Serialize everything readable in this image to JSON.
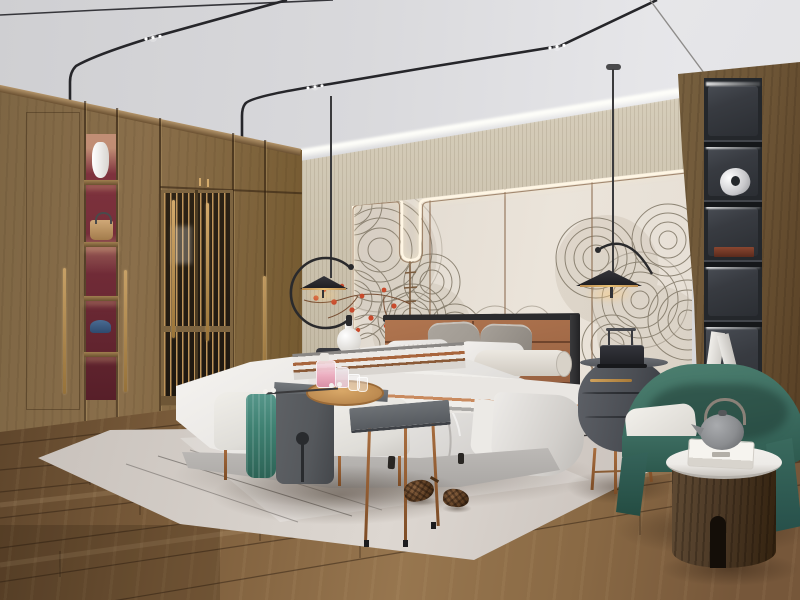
{
  "scene": {
    "type": "photorealistic-interior-render",
    "room": "modern Chinese (new-chinoiserie) bedroom",
    "objects": {
      "ceiling": "white ceiling with black magnetic track lights and LED spot dots",
      "cove_light": "warm LED cove strip above textured back wall",
      "back_wall": "cream upholstered panels outlined by a glowing LED channel with center dip",
      "mural": "grey ink wave/fan line-art mural with red blossom branch",
      "wardrobe": "full-height walnut wardrobe with lattice screen doors and lit display niche",
      "niche_items": [
        "white vase",
        "tan handbag",
        "blue cap"
      ],
      "shelf_column": "black recessed display shelves with LED tops, sculpture, wooden box, white books",
      "pendant_lamps": "two black disc pendants with C-shaped arms and warm under-glow",
      "bed": "upholstered king bed, cognac leather headboard, white duvet, striped throw",
      "pillows": [
        "grey patterned pair",
        "white pillows",
        "striped pillow",
        "teal lumbar with gold band",
        "cream bolster"
      ],
      "nightstand_left": "dark stand with white gourd vase",
      "nightstand_right": "oval graphite two-drawer stand with brass handle and trolley-style lamp",
      "bench": "white bench with teal towel, grey saddle table, wooden tray with pink perfume bottles and glasses",
      "side_table": "grey slab side table on copper legs",
      "armchair": "teal curved-shell armchair with white seat cushion",
      "drum_table": "dark walnut cylinder side table, marble top, grey teapot on white box",
      "rug": "light grey area rug with thin line pattern and two pine cones",
      "floor": "warm brown wood plank floor"
    }
  },
  "colors": {
    "ceiling": "#dcdcdf",
    "wall_texture": "#cdc4b0",
    "panel_cream": "#ebe4da",
    "led_glow": "#fff6e4",
    "trim_brown": "#8a6a4e",
    "mural_line": "#7f7665",
    "flower_red": "#c84a2c",
    "wardrobe_wood": "#8a6f4b",
    "niche_red": "#722c38",
    "lattice_gold": "#c69a5e",
    "handle_gold": "#d3aa6c",
    "right_wood": "#6d5536",
    "shelf_black": "#24272b",
    "shelf_back": "#383b41",
    "headboard_cognac": "#a16947",
    "bed_white": "#e4e2df",
    "pillow_gray": "#9d978f",
    "teal_accent": "#47806f",
    "throw_rust": "#c98a5e",
    "bench_white": "#dfddd8",
    "saddle_gray": "#55585c",
    "towel_teal": "#3f8172",
    "tray_wood": "#bc8a50",
    "perfume_pink": "#ecaec0",
    "nightstand_gray": "#4b4e54",
    "armchair_teal": "#3c6c60",
    "cylinder_wood": "#4c3926",
    "marble_white": "#edebe7",
    "teapot_gray": "#8b8d90",
    "rug_light": "#d8d2cc",
    "floor_mid": "#8a6a45",
    "floor_dark": "#5e452b",
    "pinecone_brown": "#5c3d22",
    "copper": "#a96e3f",
    "cord_black": "#3a3a3c"
  }
}
